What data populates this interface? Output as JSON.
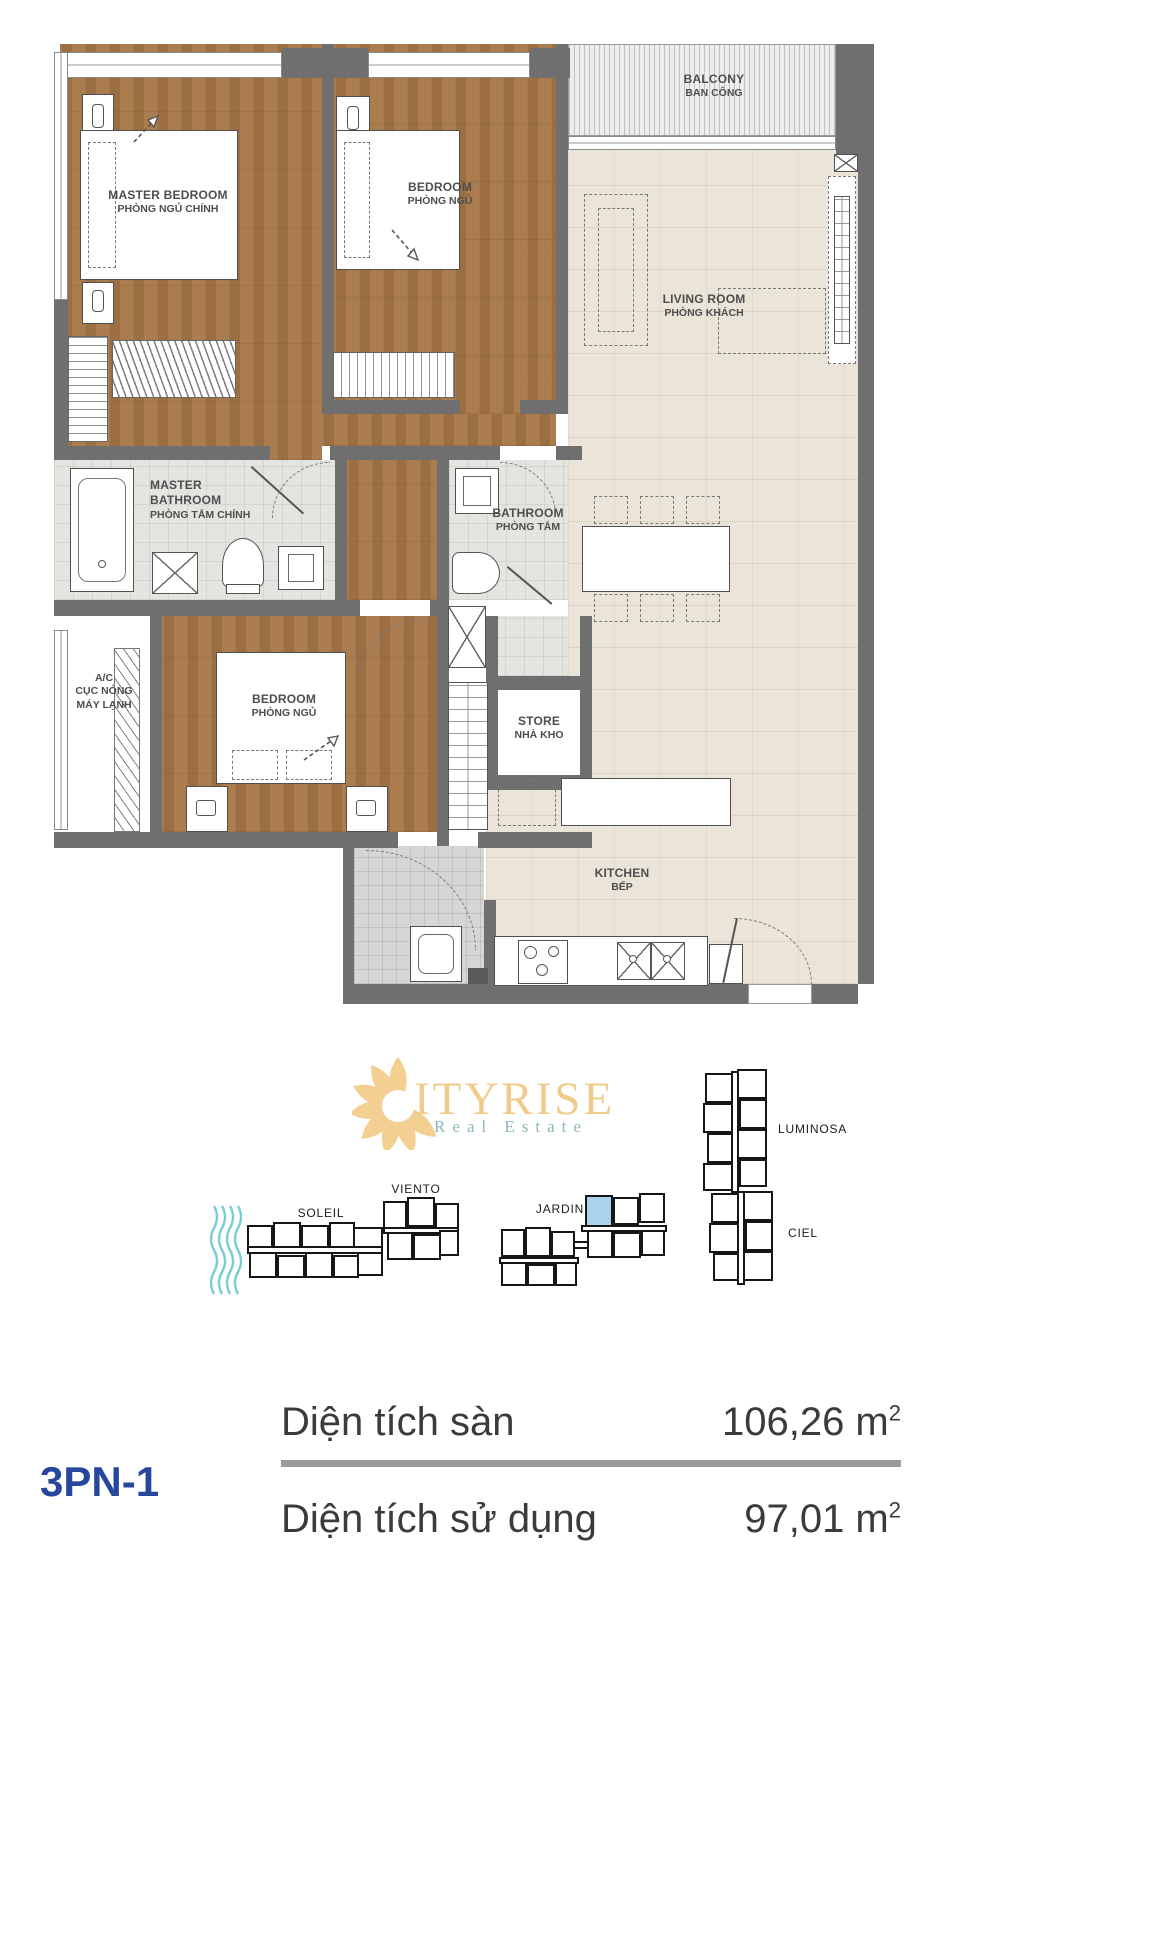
{
  "plan": {
    "rooms": {
      "master_bedroom": {
        "l1": "MASTER BEDROOM",
        "l2": "PHÒNG NGỦ CHÍNH"
      },
      "bedroom_top": {
        "l1": "BEDROOM",
        "l2": "PHÒNG NGỦ"
      },
      "balcony": {
        "l1": "BALCONY",
        "l2": "BAN CÔNG"
      },
      "living_room": {
        "l1": "LIVING ROOM",
        "l2": "PHÒNG KHÁCH"
      },
      "master_bathroom": {
        "l1": "MASTER",
        "l2": "BATHROOM",
        "l3": "PHÒNG TẮM CHÍNH"
      },
      "bathroom": {
        "l1": "BATHROOM",
        "l2": "PHÒNG TẮM"
      },
      "ac": {
        "l1": "A/C",
        "l2": "CỤC NÓNG",
        "l3": "MÁY LẠNH"
      },
      "bedroom_bottom": {
        "l1": "BEDROOM",
        "l2": "PHÒNG NGỦ"
      },
      "store": {
        "l1": "STORE",
        "l2": "NHÀ KHO"
      },
      "kitchen": {
        "l1": "KITCHEN",
        "l2": "BẾP"
      }
    }
  },
  "logo": {
    "brand": "ITYRISE",
    "tagline": "Real Estate"
  },
  "site_map": {
    "buildings": [
      {
        "name": "SOLEIL"
      },
      {
        "name": "VIENTO"
      },
      {
        "name": "JARDIN"
      },
      {
        "name": "LUMINOSA"
      },
      {
        "name": "CIEL"
      }
    ],
    "highlighted_building": "JARDIN",
    "highlight_color": "#a9d3ea"
  },
  "unit": {
    "code": "3PN-1",
    "rows": [
      {
        "label": "Diện tích sàn",
        "value": "106,26 m",
        "exp": "2"
      },
      {
        "label": "Diện tích sử dụng",
        "value": "97,01 m",
        "exp": "2"
      }
    ]
  },
  "colors": {
    "wall": "#6f6f6f",
    "wood": "#ab7c4d",
    "code_blue": "#26479d",
    "logo_gold": "#f0cc8c",
    "logo_teal": "#8db6bf"
  }
}
